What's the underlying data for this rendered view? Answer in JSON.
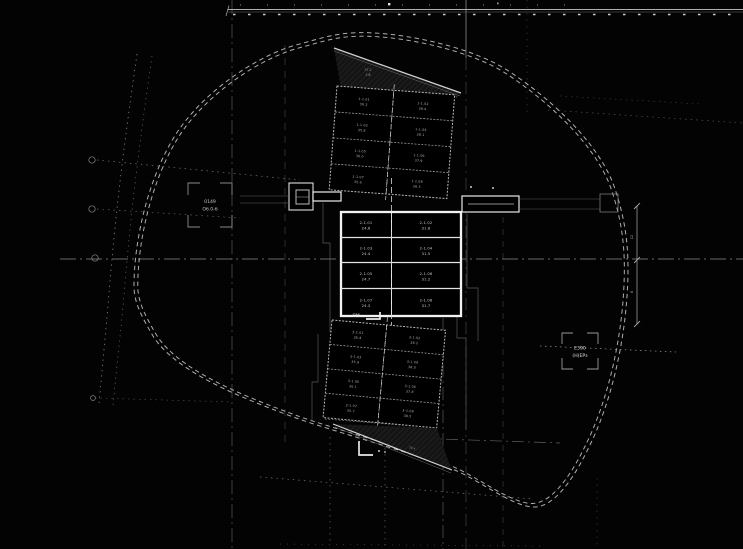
{
  "colors": {
    "background": "#030303",
    "wall_bright": "#f2f2f2",
    "line_mid": "#9a9a9a",
    "line_dim": "#4f4f4f"
  },
  "markers": {
    "left_box": {
      "line1": "0149",
      "line2": "Об.0-б"
    },
    "right_box": {
      "line1": "Е390",
      "line2": "(Н)ЕРз"
    }
  },
  "annotations": {
    "om": "ОМ",
    "upper_wedge_area": "37.2",
    "upper_wedge_slope": "1:8",
    "lower_wedge_area": "28.4",
    "dim_a": "12",
    "dim_b": "8"
  },
  "blocks": {
    "upper": {
      "cells": [
        [
          "1-1.01",
          "36.2"
        ],
        [
          "1-1.02",
          "38.4"
        ],
        [
          "1-1.03",
          "35.8"
        ],
        [
          "1-1.04",
          "38.1"
        ],
        [
          "1-1.05",
          "36.0"
        ],
        [
          "1-1.06",
          "37.9"
        ],
        [
          "1-1.07",
          "35.6"
        ],
        [
          "1-1.08",
          "38.3"
        ]
      ]
    },
    "central": {
      "cells": [
        [
          "2-1.01",
          "24.6"
        ],
        [
          "2-1.02",
          "31.8"
        ],
        [
          "2-1.03",
          "24.4"
        ],
        [
          "2-1.04",
          "31.5"
        ],
        [
          "2-1.05",
          "24.7"
        ],
        [
          "2-1.06",
          "31.2"
        ],
        [
          "2-1.07",
          "24.3"
        ],
        [
          "2-1.08",
          "31.7"
        ]
      ]
    },
    "lower": {
      "cells": [
        [
          "3-1.01",
          "36.4"
        ],
        [
          "3-1.02",
          "38.2"
        ],
        [
          "3-1.03",
          "35.9"
        ],
        [
          "3-1.04",
          "38.0"
        ],
        [
          "3-1.05",
          "36.1"
        ],
        [
          "3-1.06",
          "37.8"
        ],
        [
          "3-1.07",
          "35.7"
        ],
        [
          "3-1.08",
          "38.5"
        ]
      ]
    }
  }
}
